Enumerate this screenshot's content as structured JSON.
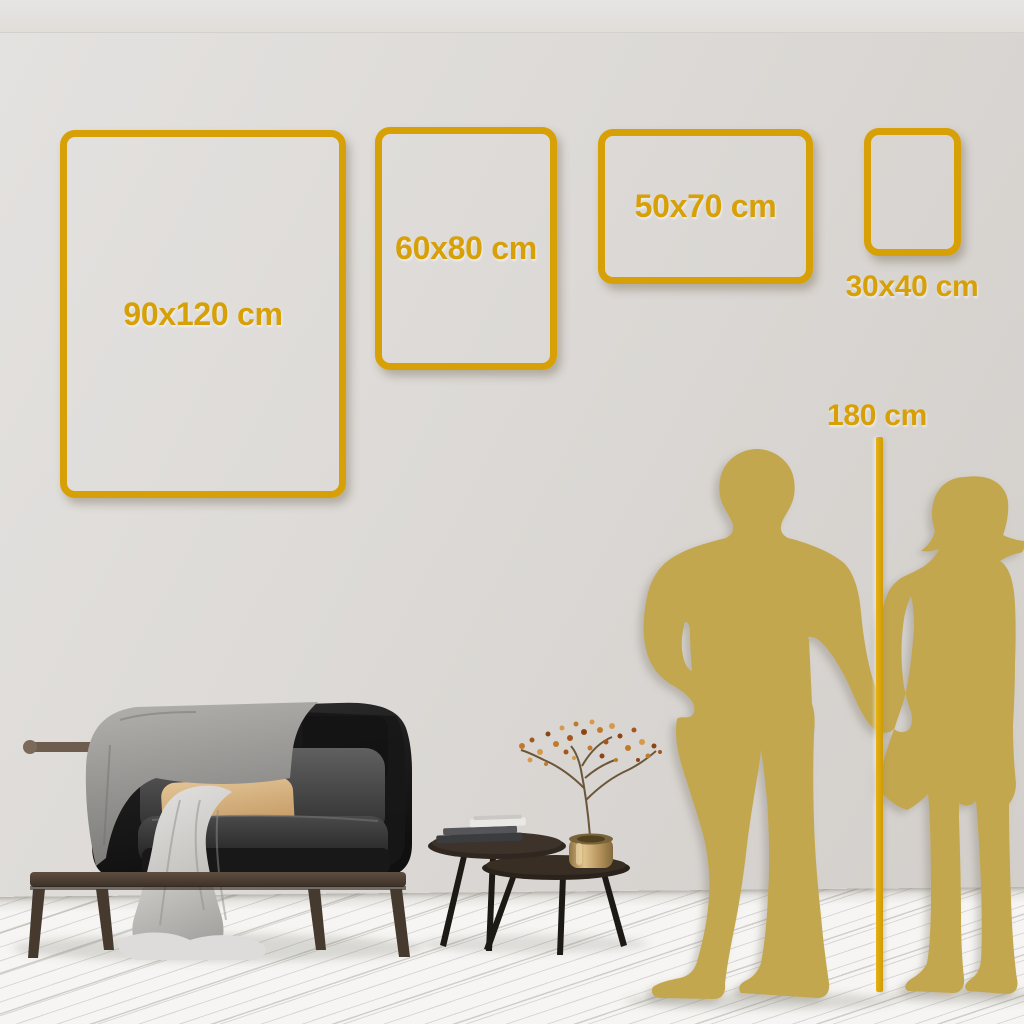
{
  "title": "Wall art size guide",
  "frames": [
    {
      "label": "90x120 cm",
      "width_cm": 90,
      "height_cm": 120
    },
    {
      "label": "60x80 cm",
      "width_cm": 60,
      "height_cm": 80
    },
    {
      "label": "50x70 cm",
      "width_cm": 50,
      "height_cm": 70
    },
    {
      "label": "30x40 cm",
      "width_cm": 30,
      "height_cm": 40
    }
  ],
  "reference": {
    "label": "180 cm",
    "value_cm": 180
  },
  "colors": {
    "gold": "#D7A007",
    "silhouette": "#C3A74F",
    "wall": "#DBD8D5",
    "floor": "#F5F4F2"
  }
}
